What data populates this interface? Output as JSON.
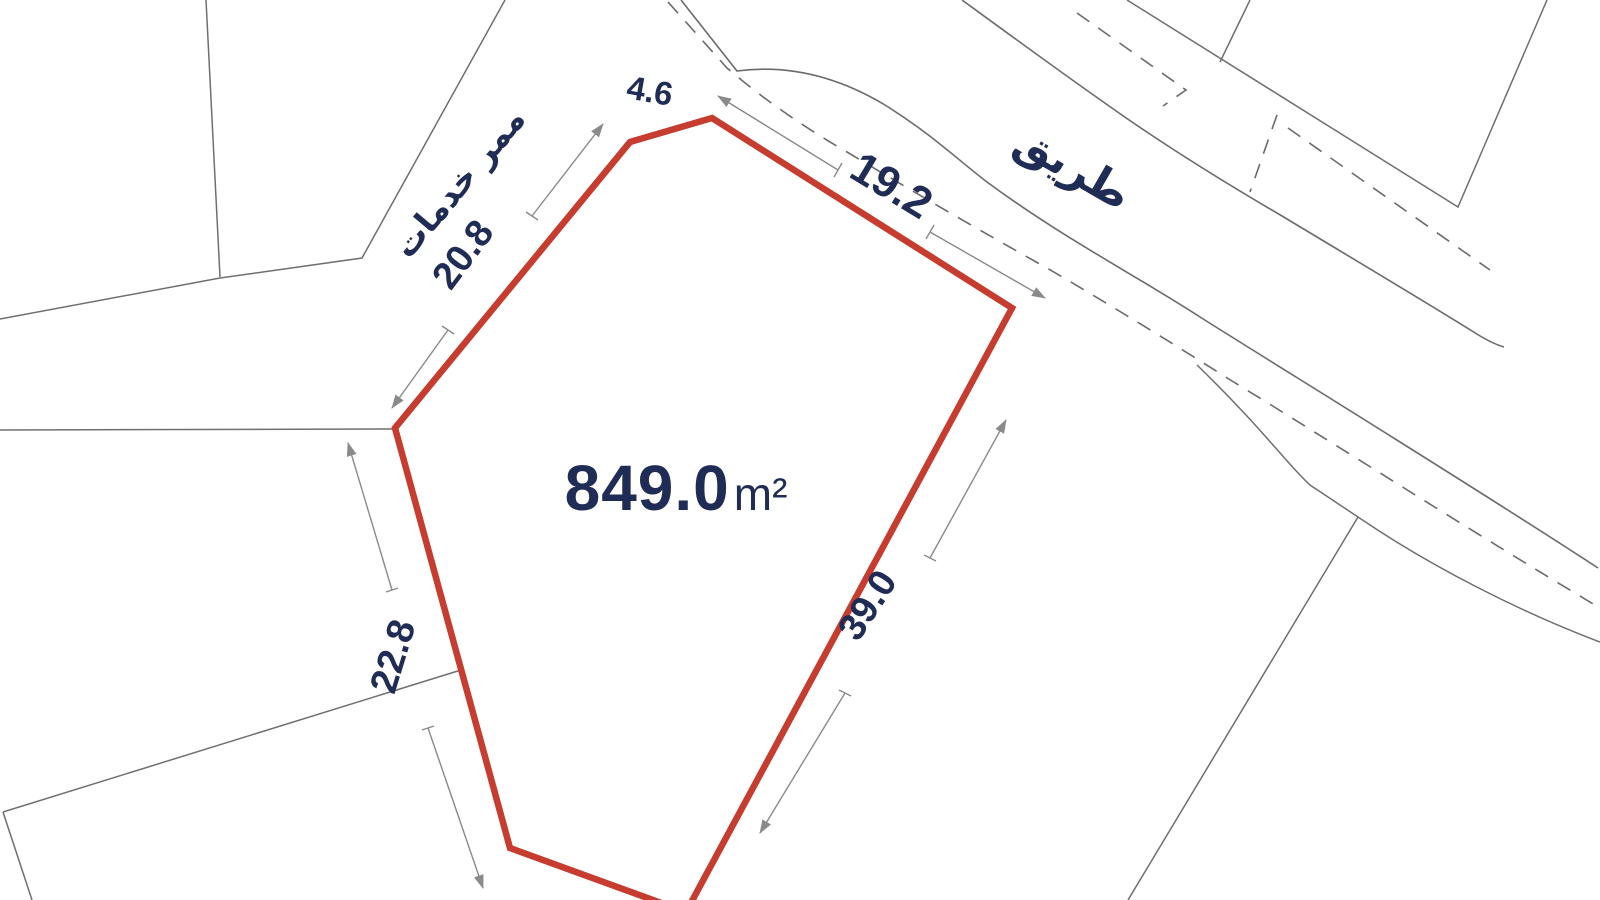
{
  "map": {
    "type": "cadastral-survey-plot",
    "background_color": "#ffffff"
  },
  "plot": {
    "area_value": "849.0",
    "area_unit": "m²",
    "boundary_color": "#c63c2e",
    "dimensions": {
      "top_edge": "4.6",
      "northwest_edge": "20.8",
      "northeast_edge": "19.2",
      "west_edge": "22.8",
      "southeast_edge": "39.0"
    }
  },
  "labels": {
    "road": "طريق",
    "service_corridor": "ممر خدمات"
  },
  "colors": {
    "text": "#1f2c55",
    "parcel_lines": "#6f6f6f",
    "dimension_lines": "#8a8a8a"
  }
}
